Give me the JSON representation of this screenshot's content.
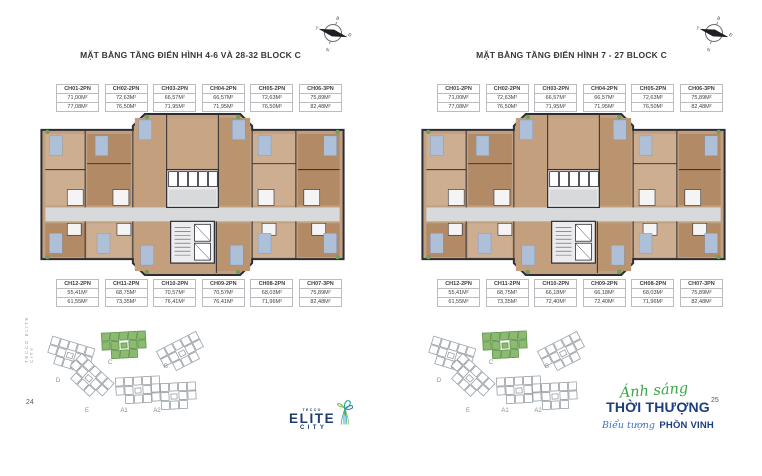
{
  "document": {
    "left_page_number": "24",
    "right_page_number": "25",
    "spine_text": "TECCO ELITE CITY"
  },
  "compass": {
    "north_label": "B",
    "east_label": "Đ",
    "south_label": "N",
    "west_label": "T"
  },
  "panels": [
    {
      "title": "MẶT BẰNG TẦNG ĐIỂN HÌNH 4-6 VÀ 28-32 BLOCK C",
      "top_units": [
        {
          "code": "CH01-2PN",
          "area_net": "71,00M²",
          "area_gross": "77,08M²"
        },
        {
          "code": "CH02-2PN",
          "area_net": "72,63M²",
          "area_gross": "76,50M²"
        },
        {
          "code": "CH03-2PN",
          "area_net": "66,57M²",
          "area_gross": "71,95M²"
        },
        {
          "code": "CH04-2PN",
          "area_net": "66,57M²",
          "area_gross": "71,95M²"
        },
        {
          "code": "CH05-2PN",
          "area_net": "72,63M²",
          "area_gross": "76,50M²"
        },
        {
          "code": "CH06-3PN",
          "area_net": "75,89M²",
          "area_gross": "82,48M²"
        }
      ],
      "bottom_units": [
        {
          "code": "CH12-2PN",
          "area_net": "55,41M²",
          "area_gross": "61,55M²"
        },
        {
          "code": "CH11-2PN",
          "area_net": "68,75M²",
          "area_gross": "73,35M²"
        },
        {
          "code": "CH10-2PN",
          "area_net": "70,57M²",
          "area_gross": "76,41M²"
        },
        {
          "code": "CH09-2PN",
          "area_net": "70,57M²",
          "area_gross": "76,41M²"
        },
        {
          "code": "CH08-2PN",
          "area_net": "68,03M²",
          "area_gross": "71,96M²"
        },
        {
          "code": "CH07-3PN",
          "area_net": "75,89M²",
          "area_gross": "82,48M²"
        }
      ]
    },
    {
      "title": "MẶT BẰNG TẦNG ĐIỂN HÌNH 7 - 27 BLOCK C",
      "top_units": [
        {
          "code": "CH01-2PN",
          "area_net": "71,00M²",
          "area_gross": "77,08M²"
        },
        {
          "code": "CH02-2PN",
          "area_net": "72,63M²",
          "area_gross": "76,50M²"
        },
        {
          "code": "CH03-2PN",
          "area_net": "66,57M²",
          "area_gross": "71,95M²"
        },
        {
          "code": "CH04-2PN",
          "area_net": "66,57M²",
          "area_gross": "71,95M²"
        },
        {
          "code": "CH05-2PN",
          "area_net": "72,63M²",
          "area_gross": "76,50M²"
        },
        {
          "code": "CH06-3PN",
          "area_net": "75,89M²",
          "area_gross": "82,48M²"
        }
      ],
      "bottom_units": [
        {
          "code": "CH12-2PN",
          "area_net": "55,41M²",
          "area_gross": "61,55M²"
        },
        {
          "code": "CH11-2PN",
          "area_net": "68,75M²",
          "area_gross": "73,35M²"
        },
        {
          "code": "CH10-2PN",
          "area_net": "66,18M²",
          "area_gross": "72,40M²"
        },
        {
          "code": "CH09-2PN",
          "area_net": "66,18M²",
          "area_gross": "72,40M²"
        },
        {
          "code": "CH08-2PN",
          "area_net": "68,03M²",
          "area_gross": "71,96M²"
        },
        {
          "code": "CH07-3PN",
          "area_net": "75,89M²",
          "area_gross": "82,48M²"
        }
      ]
    }
  ],
  "site_plan": {
    "block_labels": [
      "C",
      "B",
      "D",
      "E",
      "A1",
      "A2"
    ],
    "highlighted_block": "C",
    "highlight_color": "#8cba70"
  },
  "logo": {
    "brand": "TECCO",
    "line1": "ELITE",
    "line2": "CITY"
  },
  "slogan": {
    "script_top": "Ánh sáng",
    "main": "THỜI THƯỢNG",
    "script_bottom": "Biểu tượng",
    "bold_bottom": "PHỒN VINH"
  },
  "colors": {
    "title_text": "#36363b",
    "plan_wall": "#2c2c34",
    "plan_floor": "#c2a07f",
    "corridor": "#d8d9db",
    "block_outline": "#99a1a7",
    "block_highlight": "#8cba70",
    "navy": "#203a72",
    "green_script": "#3aa648",
    "blue_script": "#3a77c2"
  }
}
